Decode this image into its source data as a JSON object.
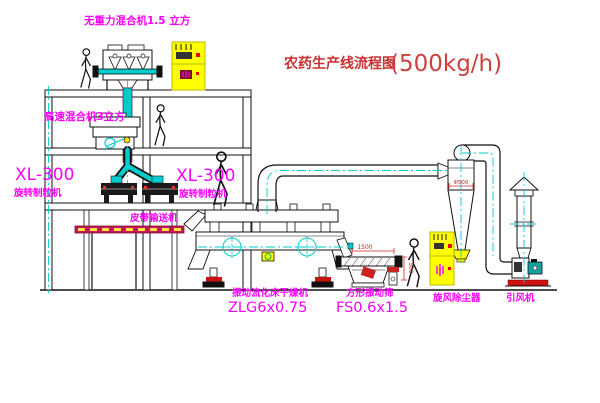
{
  "title": {
    "text": "农药生产线流程图",
    "capacity": "(500kg/h)"
  },
  "labels": {
    "gravity_mixer": "无重力混合机1.5 立方",
    "high_speed_mixer": "高速混合机3立方",
    "xl_left_model": "XL-300",
    "xl_left_name": "旋转制粒机",
    "xl_right_model": "XL-300",
    "xl_right_name": "旋转制粒机",
    "belt_conveyor": "皮带输送机",
    "dryer_name": "振动流化床干燥机",
    "dryer_model": "ZLG6x0.75",
    "screen_name": "方形振动筛",
    "screen_model": "FS0.6x1.5",
    "cyclone": "旋风除尘器",
    "fan": "引风机"
  },
  "dims": {
    "screen_length": "1500",
    "screen_height": "500",
    "cyclone_diameter": "Φ500"
  },
  "colors": {
    "label_magenta": "#FF00FF",
    "title_red": "#C83232",
    "centerline_cyan": "#00CCCC",
    "equipment_yellow": "#FFFF00",
    "support_red": "#CC1111",
    "conveyor_magenta": "#C2185B",
    "line_black": "#111111"
  }
}
